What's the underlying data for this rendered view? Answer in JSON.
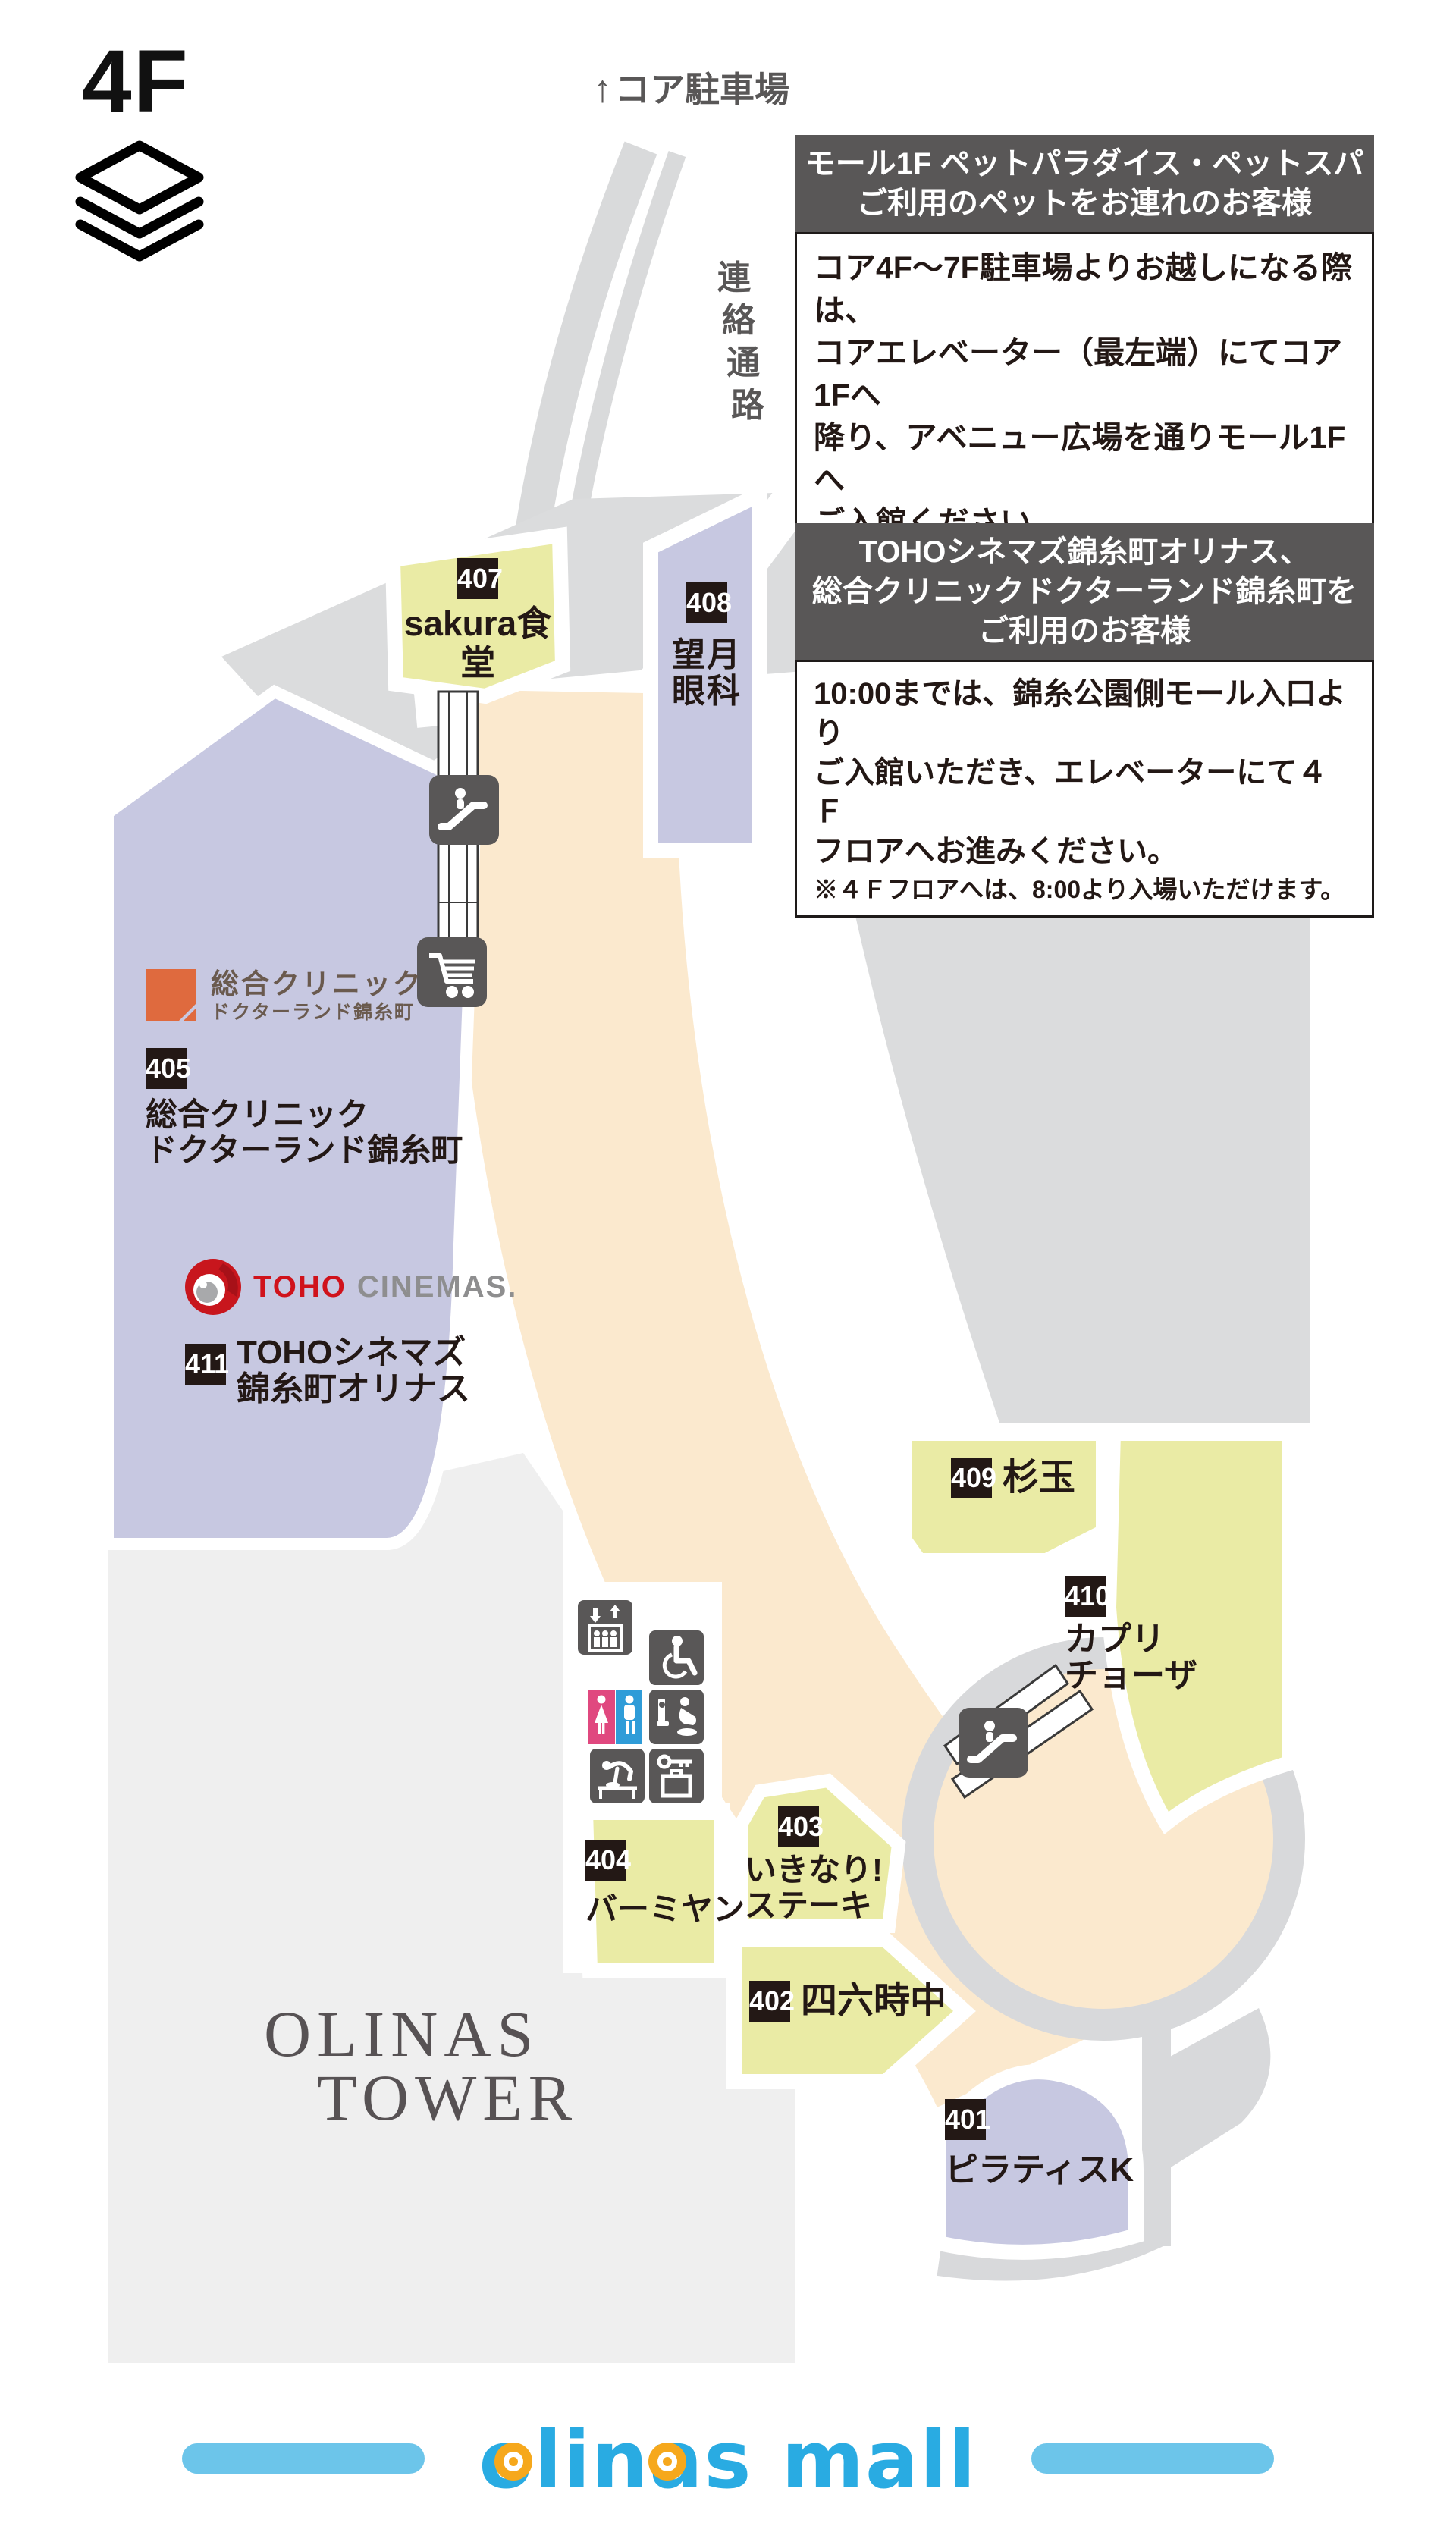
{
  "floor": "4F",
  "parking_label": {
    "arrow": "↑",
    "text": "コア駐車場"
  },
  "corridor_label": {
    "chars": [
      "連",
      "絡",
      "通",
      "路"
    ]
  },
  "notices": [
    {
      "header_lines": [
        "モール1F ペットパラダイス・ペットスパ",
        "ご利用のペットをお連れのお客様"
      ],
      "body_lines": [
        "コア4F～7F駐車場よりお越しになる際は、",
        "コアエレベーター（最左端）にてコア1Fへ",
        "降り、アベニュー広場を通りモール1Fへ",
        "ご入館ください。"
      ],
      "note_lines": [
        "※必ずキャリーバッグ（頭まで全身が隠れるもの）",
        "をご利用ください。"
      ]
    },
    {
      "header_lines": [
        "TOHOシネマズ錦糸町オリナス、",
        "総合クリニックドクターランド錦糸町を",
        "ご利用のお客様"
      ],
      "body_lines": [
        "10:00までは、錦糸公園側モール入口より",
        "ご入館いただき、エレベーターにて４Ｆ",
        "フロアへお進みください。"
      ],
      "note_lines": [
        "※４Ｆフロアへは、8:00より入場いただけます。"
      ]
    }
  ],
  "stores": [
    {
      "number": "401",
      "name": "ピラティスK"
    },
    {
      "number": "402",
      "name": "四六時中"
    },
    {
      "number": "403",
      "name_lines": [
        "いきなり!",
        "ステーキ"
      ]
    },
    {
      "number": "404",
      "name": "バーミヤン"
    },
    {
      "number": "405",
      "name_lines": [
        "総合クリニック",
        "ドクターランド錦糸町"
      ]
    },
    {
      "number": "407",
      "name": "sakura食堂"
    },
    {
      "number": "408",
      "name_lines": [
        "望月",
        "眼科"
      ]
    },
    {
      "number": "409",
      "name": "杉玉"
    },
    {
      "number": "410",
      "name_lines": [
        "カプリ",
        "チョーザ"
      ]
    },
    {
      "number": "411",
      "name_lines": [
        "TOHOシネマズ",
        "錦糸町オリナス"
      ]
    }
  ],
  "logos": {
    "clinic": {
      "line1": "総合クリニック",
      "line2": "ドクターランド錦糸町"
    },
    "toho": {
      "brand": "TOHO",
      "suffix": "CINEMAS."
    },
    "tower": {
      "line1": "OLINAS",
      "line2": "TOWER"
    },
    "mall": {
      "wordmark": "olinas mall"
    }
  },
  "icons": [
    "layers-icon",
    "up-arrow-icon",
    "escalator-icon",
    "shopping-cart-icon",
    "elevator-icon",
    "wheelchair-icon",
    "restrooms-icon",
    "toilet-baby-seat-icon",
    "baby-changing-icon",
    "coin-locker-icon"
  ],
  "colors": {
    "store_yellow": "#eaeba5",
    "store_lavender": "#c7c8e1",
    "walkway_beige": "#fbe9ce",
    "map_gray": "#dbdcdd",
    "tower_gray": "#efefef",
    "panel_dark": "#595757",
    "number_black": "#231815",
    "brand_blue": "#29abe2",
    "brand_light_blue": "#6cc5ea",
    "brand_orange": "#f6a81c",
    "toho_red": "#d0121b",
    "clinic_orange": "#df6a3e",
    "toilet_pink": "#e0487f",
    "toilet_blue": "#2f9cd8"
  }
}
